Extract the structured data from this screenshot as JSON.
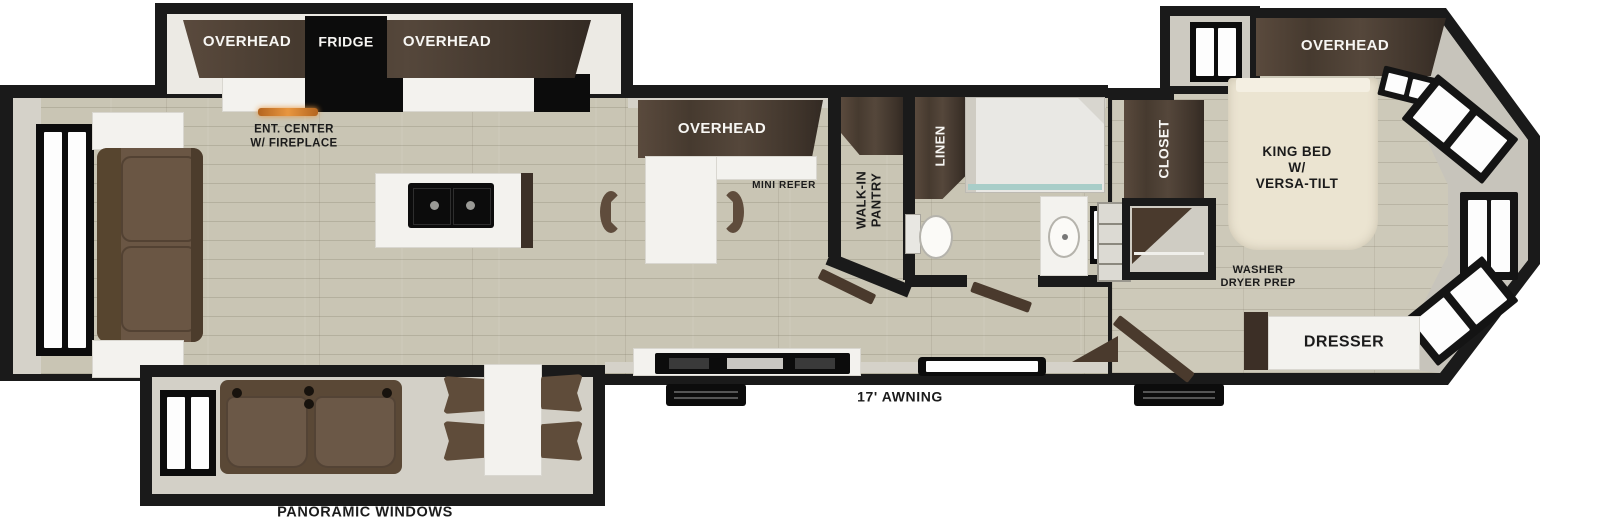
{
  "floorplan": {
    "labels": {
      "slide_rear_overhead_left": "OVERHEAD",
      "slide_rear_fridge": "FRIDGE",
      "slide_rear_overhead_right": "OVERHEAD",
      "ent_center": [
        "ENT. CENTER",
        "W/ FIREPLACE"
      ],
      "kitchen_overhead": "OVERHEAD",
      "mini_refer": "MINI REFER",
      "walk_in_pantry": [
        "WALK-IN",
        "PANTRY"
      ],
      "linen": "LINEN",
      "closet": "CLOSET",
      "bedroom_overhead": "OVERHEAD",
      "king_bed": [
        "KING BED",
        "W/",
        "VERSA-TILT"
      ],
      "washer_dryer_prep": [
        "WASHER",
        "DRYER PREP"
      ],
      "dresser": "DRESSER",
      "awning": "17' AWNING",
      "panoramic_windows": "PANORAMIC WINDOWS"
    },
    "colors": {
      "wall": "#1a1a1a",
      "floor_wood": "#c9c5b4",
      "interior_lining": "#d5d2c9",
      "cabinet_dark_brown": "#46392e",
      "counter_white": "#f3f2ee",
      "appliance_black": "#0c0c0c",
      "sofa_brown": "#6a5644",
      "bed_cream": "#ebe4d1",
      "fireplace_glow": "#d07a28",
      "shower_glass": "#a8cdc8"
    }
  }
}
